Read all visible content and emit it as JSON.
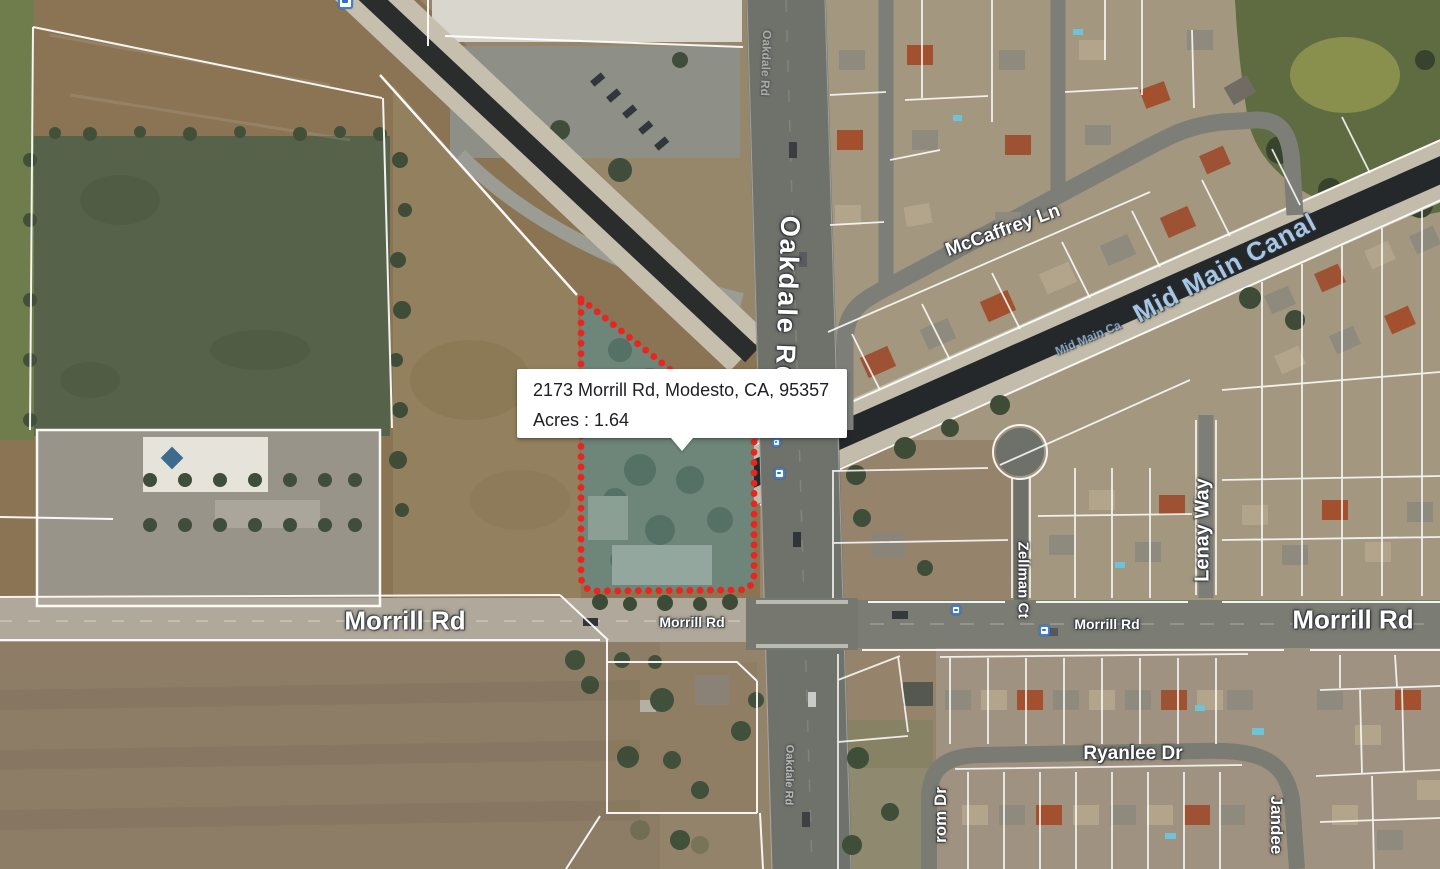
{
  "window": {
    "width": 1440,
    "height": 869
  },
  "map": {
    "kind": "satellite-parcel-map",
    "tooltip": {
      "address": "2173 Morrill Rd, Modesto, CA, 95357",
      "acres": "Acres : 1.64"
    },
    "subject_parcel": {
      "outline_color": "#e8251f",
      "outline_style": "dotted",
      "fill_color": "rgba(104,142,132,0.45)"
    },
    "palette": {
      "road_label": "#ffffff",
      "canal_label": "#a5c6e4",
      "canal_water": "#24282b",
      "road_gray": "#75766f"
    },
    "street_labels": [
      {
        "id": "oakdale-rd",
        "text": "Oakdale Rd",
        "x": 787,
        "y": 300,
        "rotate": 92,
        "size": 27,
        "ls": 2
      },
      {
        "id": "oakdale-rd-ghost-top",
        "text": "Oakdale Rd",
        "x": 766,
        "y": 63,
        "rotate": 92,
        "size": 12,
        "opacity": 0.4
      },
      {
        "id": "oakdale-rd-ghost-bottom",
        "text": "Oakdale Rd",
        "x": 789,
        "y": 775,
        "rotate": 91,
        "size": 11,
        "opacity": 0.5
      },
      {
        "id": "mccaffrey-ln",
        "text": "McCaffrey Ln",
        "x": 1003,
        "y": 231,
        "rotate": -20,
        "size": 19
      },
      {
        "id": "mid-main-canal",
        "text": "Mid Main Canal",
        "x": 1225,
        "y": 268,
        "rotate": -28,
        "size": 26,
        "color": "#a5c6e4",
        "ls": 1
      },
      {
        "id": "mid-main-canal-small",
        "text": "Mid Main Ca",
        "x": 1088,
        "y": 338,
        "rotate": -23,
        "size": 12,
        "color": "#93b6d6",
        "opacity": 0.85
      },
      {
        "id": "lenay-way",
        "text": "Lenay Way",
        "x": 1203,
        "y": 530,
        "rotate": -90,
        "size": 20
      },
      {
        "id": "morrill-rd-west",
        "text": "Morrill Rd",
        "x": 405,
        "y": 621,
        "rotate": 0,
        "size": 26
      },
      {
        "id": "morrill-rd-center",
        "text": "Morrill Rd",
        "x": 692,
        "y": 622,
        "rotate": 0,
        "size": 14
      },
      {
        "id": "morrill-rd-east-small",
        "text": "Morrill Rd",
        "x": 1107,
        "y": 624,
        "rotate": 0,
        "size": 14
      },
      {
        "id": "morrill-rd-east",
        "text": "Morrill Rd",
        "x": 1353,
        "y": 620,
        "rotate": 0,
        "size": 26
      },
      {
        "id": "zellman-ct",
        "text": "Zellman Ct",
        "x": 1023,
        "y": 580,
        "rotate": 90,
        "size": 15
      },
      {
        "id": "ryanlee-dr",
        "text": "Ryanlee Dr",
        "x": 1133,
        "y": 754,
        "rotate": 0,
        "size": 19
      },
      {
        "id": "jandee",
        "text": "Jandee",
        "x": 1276,
        "y": 825,
        "rotate": 90,
        "size": 17
      },
      {
        "id": "rom-dr",
        "text": "rom Dr",
        "x": 941,
        "y": 815,
        "rotate": -90,
        "size": 17
      }
    ],
    "transit_icons": [
      {
        "id": "bus-stop-1",
        "x": 776,
        "y": 442,
        "size": 9
      },
      {
        "id": "bus-stop-2",
        "x": 779,
        "y": 473,
        "size": 11
      },
      {
        "id": "bus-stop-3",
        "x": 956,
        "y": 610,
        "size": 10
      },
      {
        "id": "bus-stop-4",
        "x": 1044,
        "y": 630,
        "size": 11
      },
      {
        "id": "map-marker-top",
        "x": 345,
        "y": 1,
        "size": 15
      }
    ]
  }
}
